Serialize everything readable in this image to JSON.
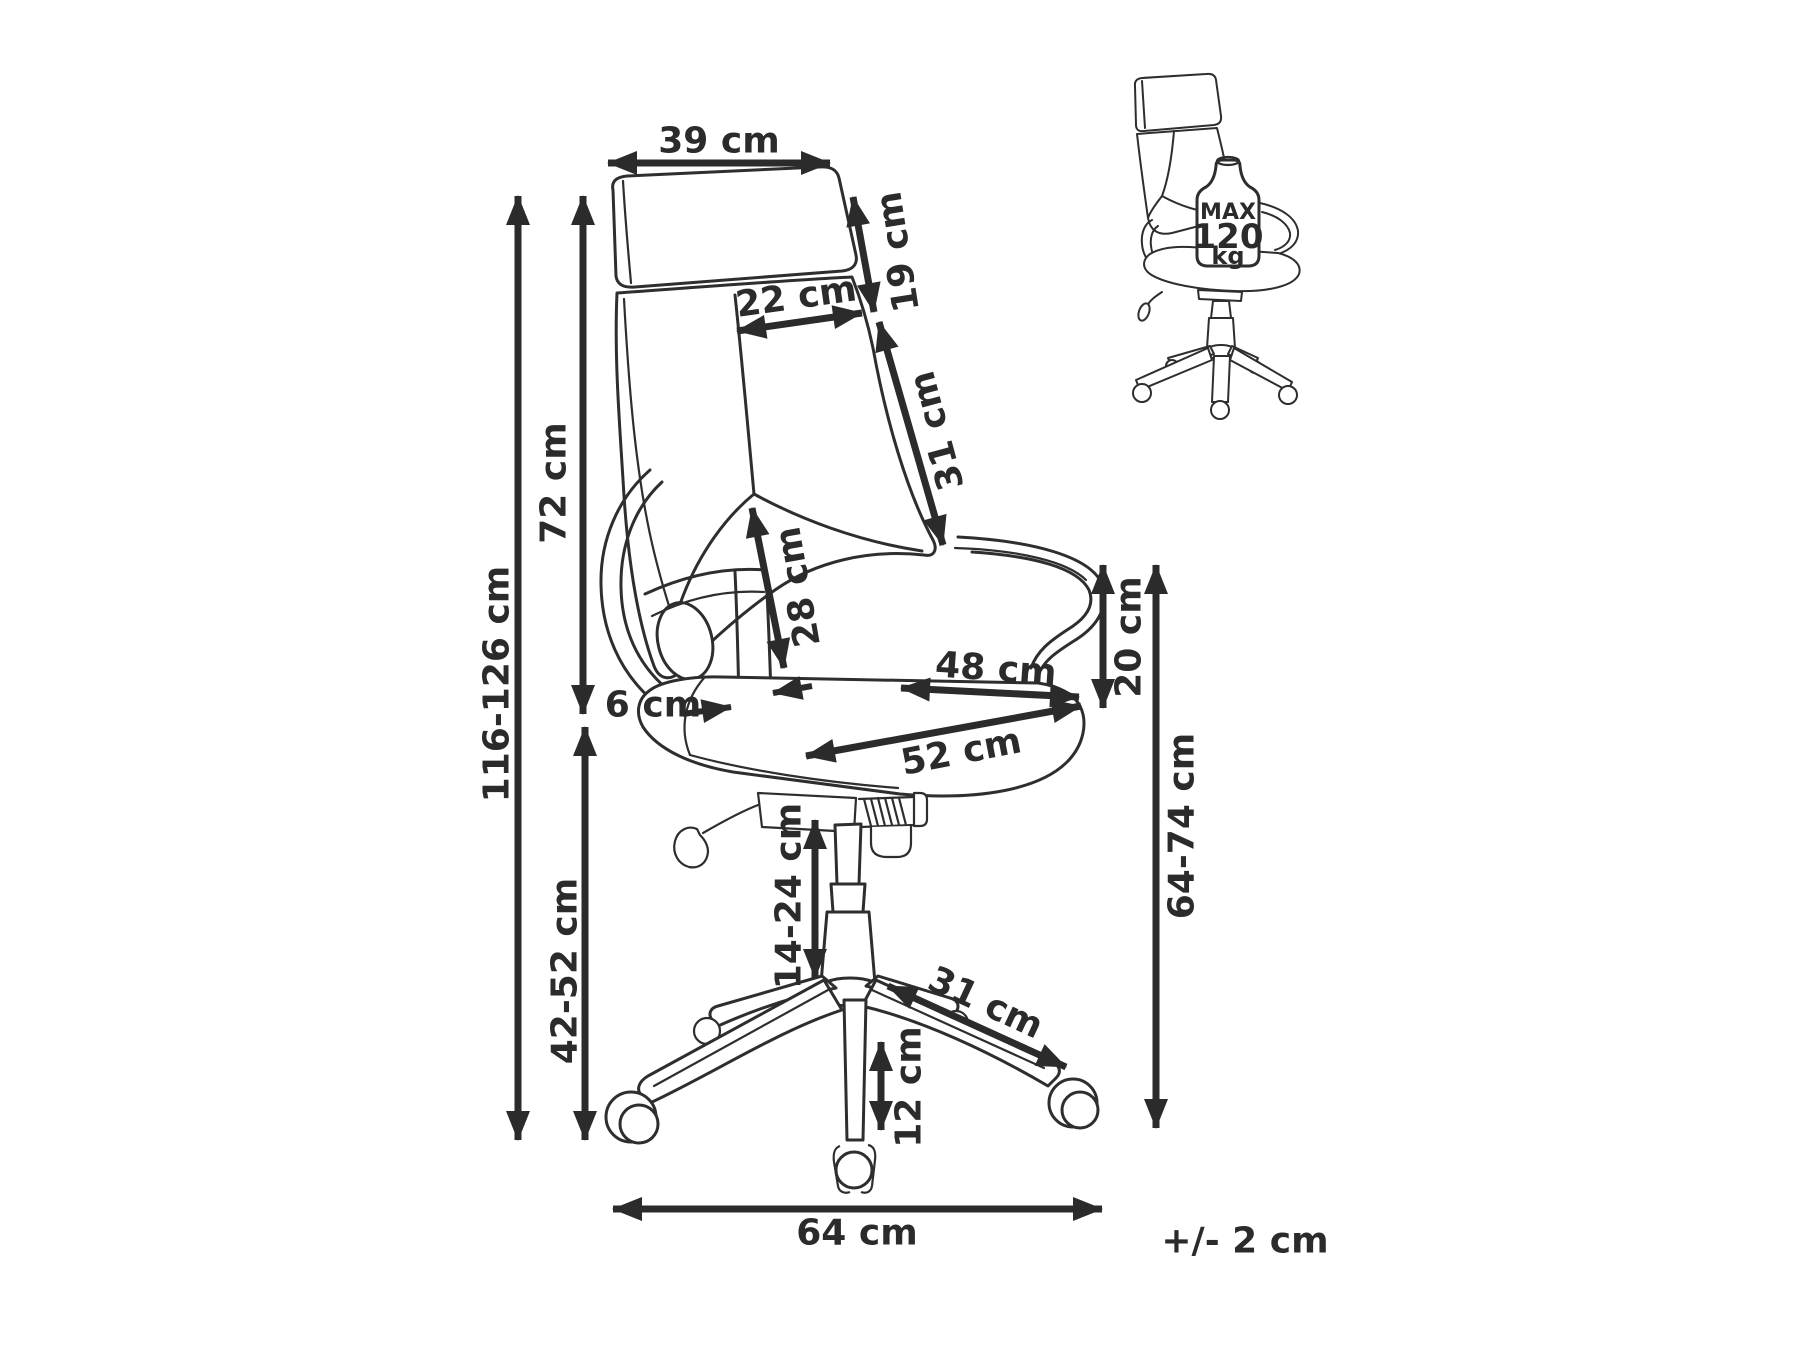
{
  "dimensions": {
    "headrest_width": "39 cm",
    "headrest_height": "19 cm",
    "backrest_panel_width": "22 cm",
    "backrest_upper_height": "31 cm",
    "backrest_inner_height": "28 cm",
    "backrest_height": "72 cm",
    "total_height": "116-126 cm",
    "seat_height_range": "42-52 cm",
    "armrest_width": "6 cm",
    "seat_width": "48 cm",
    "seat_depth": "52 cm",
    "armrest_height_above_seat": "20 cm",
    "armrest_height_from_floor": "64-74 cm",
    "gas_lift_range": "14-24 cm",
    "base_leg_length": "31 cm",
    "caster_height": "12 cm",
    "base_width": "64 cm"
  },
  "tolerance_note": "+/- 2 cm",
  "weight_limit": {
    "label": "MAX",
    "value": "120",
    "unit": "kg"
  },
  "colors": {
    "line": "#2e2e2e",
    "dimension": "#2b2b2b",
    "background": "#ffffff"
  }
}
